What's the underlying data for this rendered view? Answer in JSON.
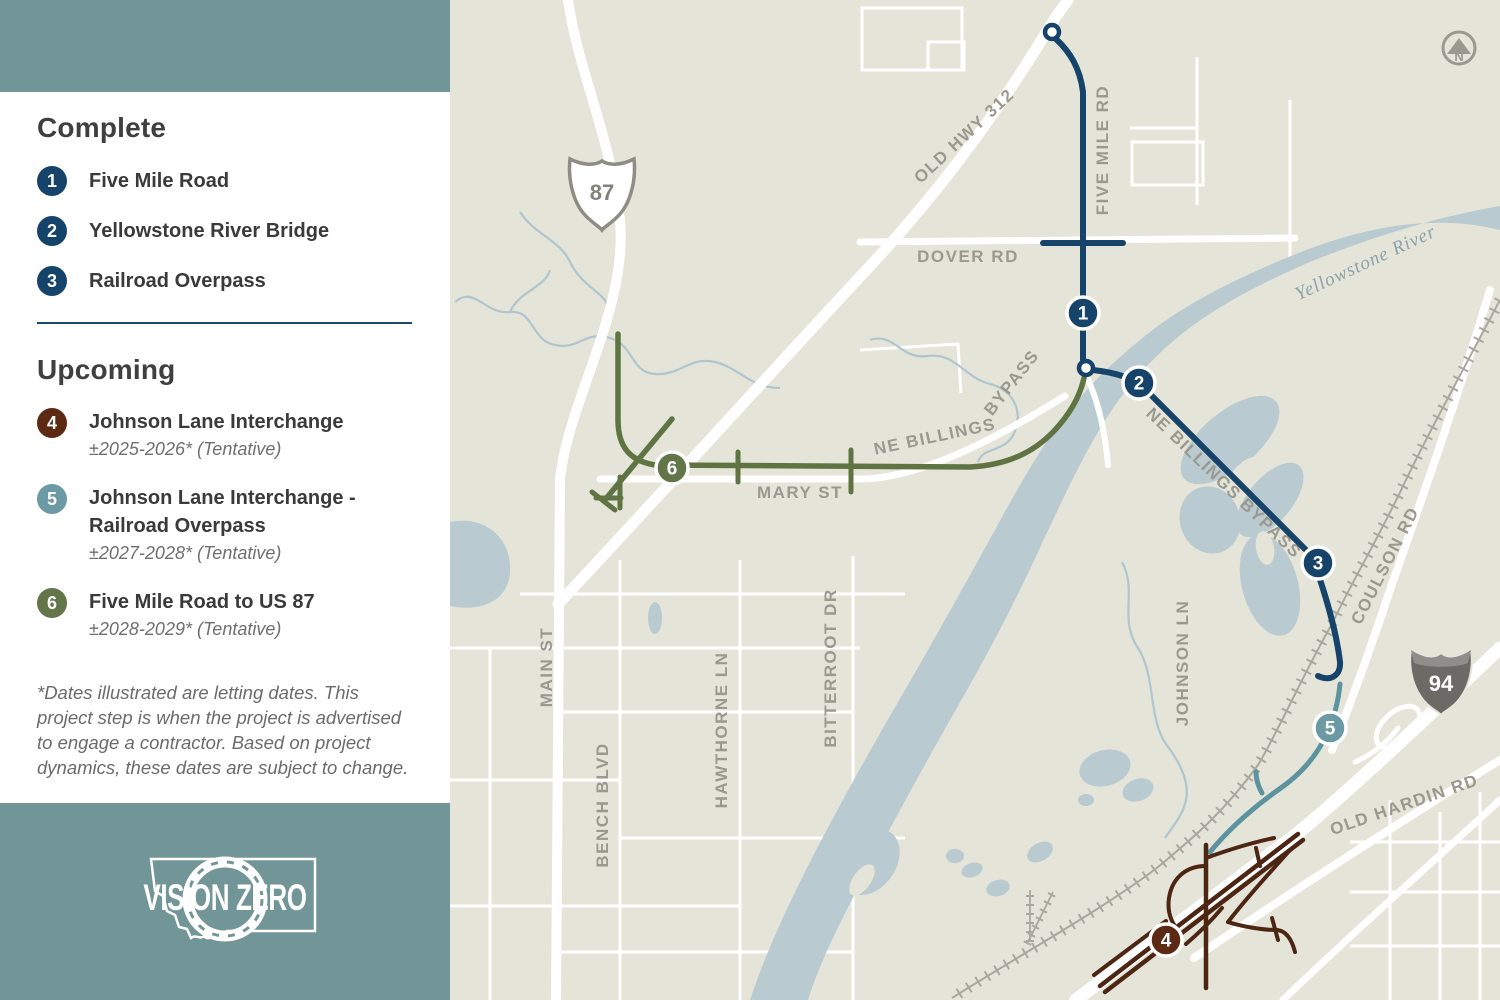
{
  "sidebar": {
    "complete": {
      "title": "Complete",
      "items": [
        {
          "num": "1",
          "label": "Five Mile Road"
        },
        {
          "num": "2",
          "label": "Yellowstone River Bridge"
        },
        {
          "num": "3",
          "label": "Railroad Overpass"
        }
      ]
    },
    "upcoming": {
      "title": "Upcoming",
      "items": [
        {
          "num": "4",
          "label": "Johnson Lane Interchange",
          "date": "±2025-2026* (Tentative)"
        },
        {
          "num": "5",
          "label": "Johnson Lane Interchange - Railroad Overpass",
          "date": "±2027-2028* (Tentative)"
        },
        {
          "num": "6",
          "label": "Five Mile Road to US 87",
          "date": "±2028-2029* (Tentative)"
        }
      ]
    },
    "footnote": "*Dates illustrated are letting dates. This project step is when the project is advertised to engage a contractor. Based on project dynamics, these dates are subject to change.",
    "logo": {
      "text": "VISION ZERO"
    }
  },
  "map": {
    "labels": {
      "old_hwy_312": "OLD HWY 312",
      "five_mile_rd": "FIVE MILE RD",
      "dover_rd": "DOVER RD",
      "ne_billings_bypass_w1": "NE BILLINGS",
      "ne_billings_bypass_w2": "BYPASS",
      "ne_billings_bypass_e": "NE BILLINGS BYPASS",
      "mary_st": "MARY ST",
      "main_st": "MAIN ST",
      "bench_blvd": "BENCH BLVD",
      "hawthorne_ln": "HAWTHORNE LN",
      "bitterroot_dr": "BITTERROOT DR",
      "johnson_ln": "JOHNSON LN",
      "coulson_rd": "COULSON RD",
      "old_hardin_rd": "OLD HARDIN RD",
      "river": "Yellowstone River"
    },
    "shields": {
      "us87": "87",
      "i94": "94"
    },
    "north_label": "N",
    "markers": [
      {
        "num": "1"
      },
      {
        "num": "2"
      },
      {
        "num": "3"
      },
      {
        "num": "4"
      },
      {
        "num": "5"
      },
      {
        "num": "6"
      }
    ]
  },
  "colors": {
    "teal_panel": "#729597",
    "navy_route": "#164369",
    "olive_route": "#5f7442",
    "teal_route": "#5d93a0",
    "brown_route": "#4d2513",
    "river": "#b9cad1",
    "label_gray": "#9a998f",
    "map_bg": "#e5e4d8"
  }
}
